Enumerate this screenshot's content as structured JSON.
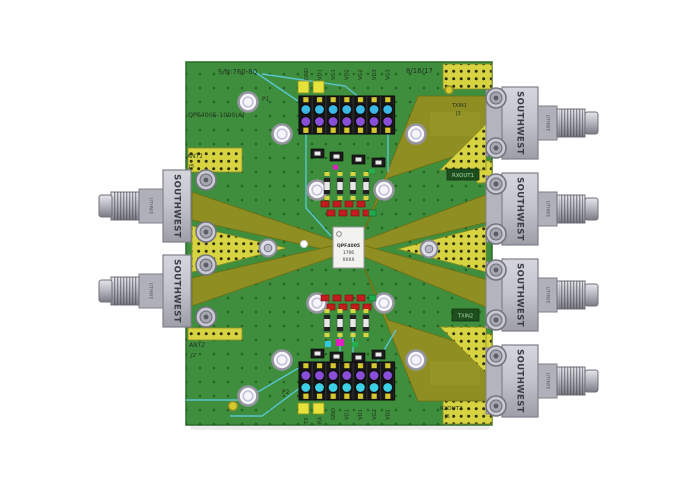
{
  "photo": {
    "description": "Rendered top view of a green RF evaluation PCB (QPF4005) with Southwest end-launch SMA connectors on left and right edges",
    "background": "#ffffff"
  },
  "board": {
    "silkscreen": {
      "serial_top": "S/N:760-80",
      "assembly": "QPF4005-1000(A)",
      "date": "8/16/17",
      "header_top_ref": "P1",
      "header_bottom_ref": "P2",
      "ant1": "ANT1",
      "ant1_ref": "J5",
      "ant2": "ANT2",
      "ant2_ref": "J2",
      "txin1": "TXIN1",
      "txin1_ref": "J3",
      "rxout1": "RXOUT1",
      "txin2": "TXIN2",
      "rxout2": "RXOUT2",
      "rxout2_ref": "J6"
    },
    "colors": {
      "soldermask": "#3e8e3d",
      "gold_trace": "#8e8e22",
      "gold_pad": "#d8d441",
      "jumper_wire": "#5bc8d8"
    }
  },
  "chip": {
    "marking_line1": "QPF4005",
    "marking_line2": "1706",
    "marking_line3": "XXXX"
  },
  "connectors": {
    "brand": "SOUTHWEST",
    "barrel_text": "UTHWE",
    "left_ports": [
      "ANT1",
      "ANT2"
    ],
    "right_ports": [
      "TXIN1",
      "RXOUT1",
      "TXIN2",
      "RXOUT2"
    ]
  },
  "headers": {
    "top": {
      "pins": [
        "GND",
        "VD1",
        "VG1",
        "VD2",
        "VG2",
        "VD3",
        "VG3"
      ]
    },
    "bottom": {
      "pins": [
        "TX",
        "RX",
        "GND",
        "VG1",
        "VD1",
        "VG2",
        "VD2"
      ]
    }
  }
}
